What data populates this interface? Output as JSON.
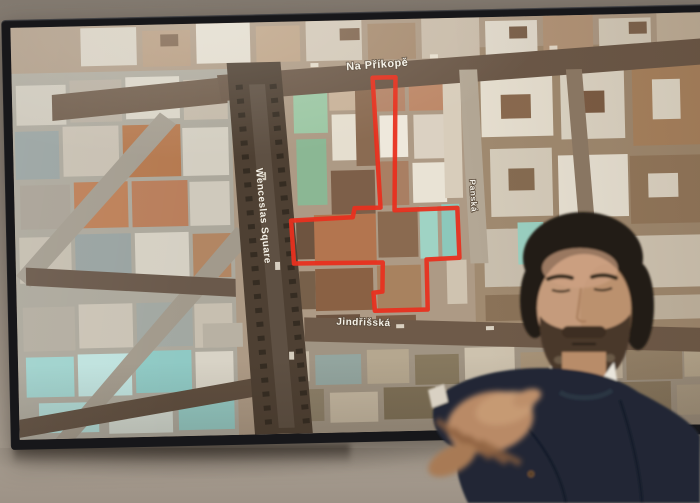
{
  "tv_map": {
    "street_labels": {
      "top": "Na Příkopě",
      "left": "Wenceslas Square",
      "right": "Panská",
      "bottom": "Jindřišská"
    },
    "site_outline_points": "362,58 385,58 381,191 444,190 445,240 412,241 412,291 359,291 358,273 367,272 368,243 279,242 277,199 339,197 341,188 367,188",
    "colors": {
      "site_outline": "#e8301f",
      "label_text": "#f4f1e8"
    }
  },
  "presenter": {
    "jacket_color": "#202735",
    "shirt_color": "#e9e5db"
  },
  "wall_color": "#a2978b"
}
